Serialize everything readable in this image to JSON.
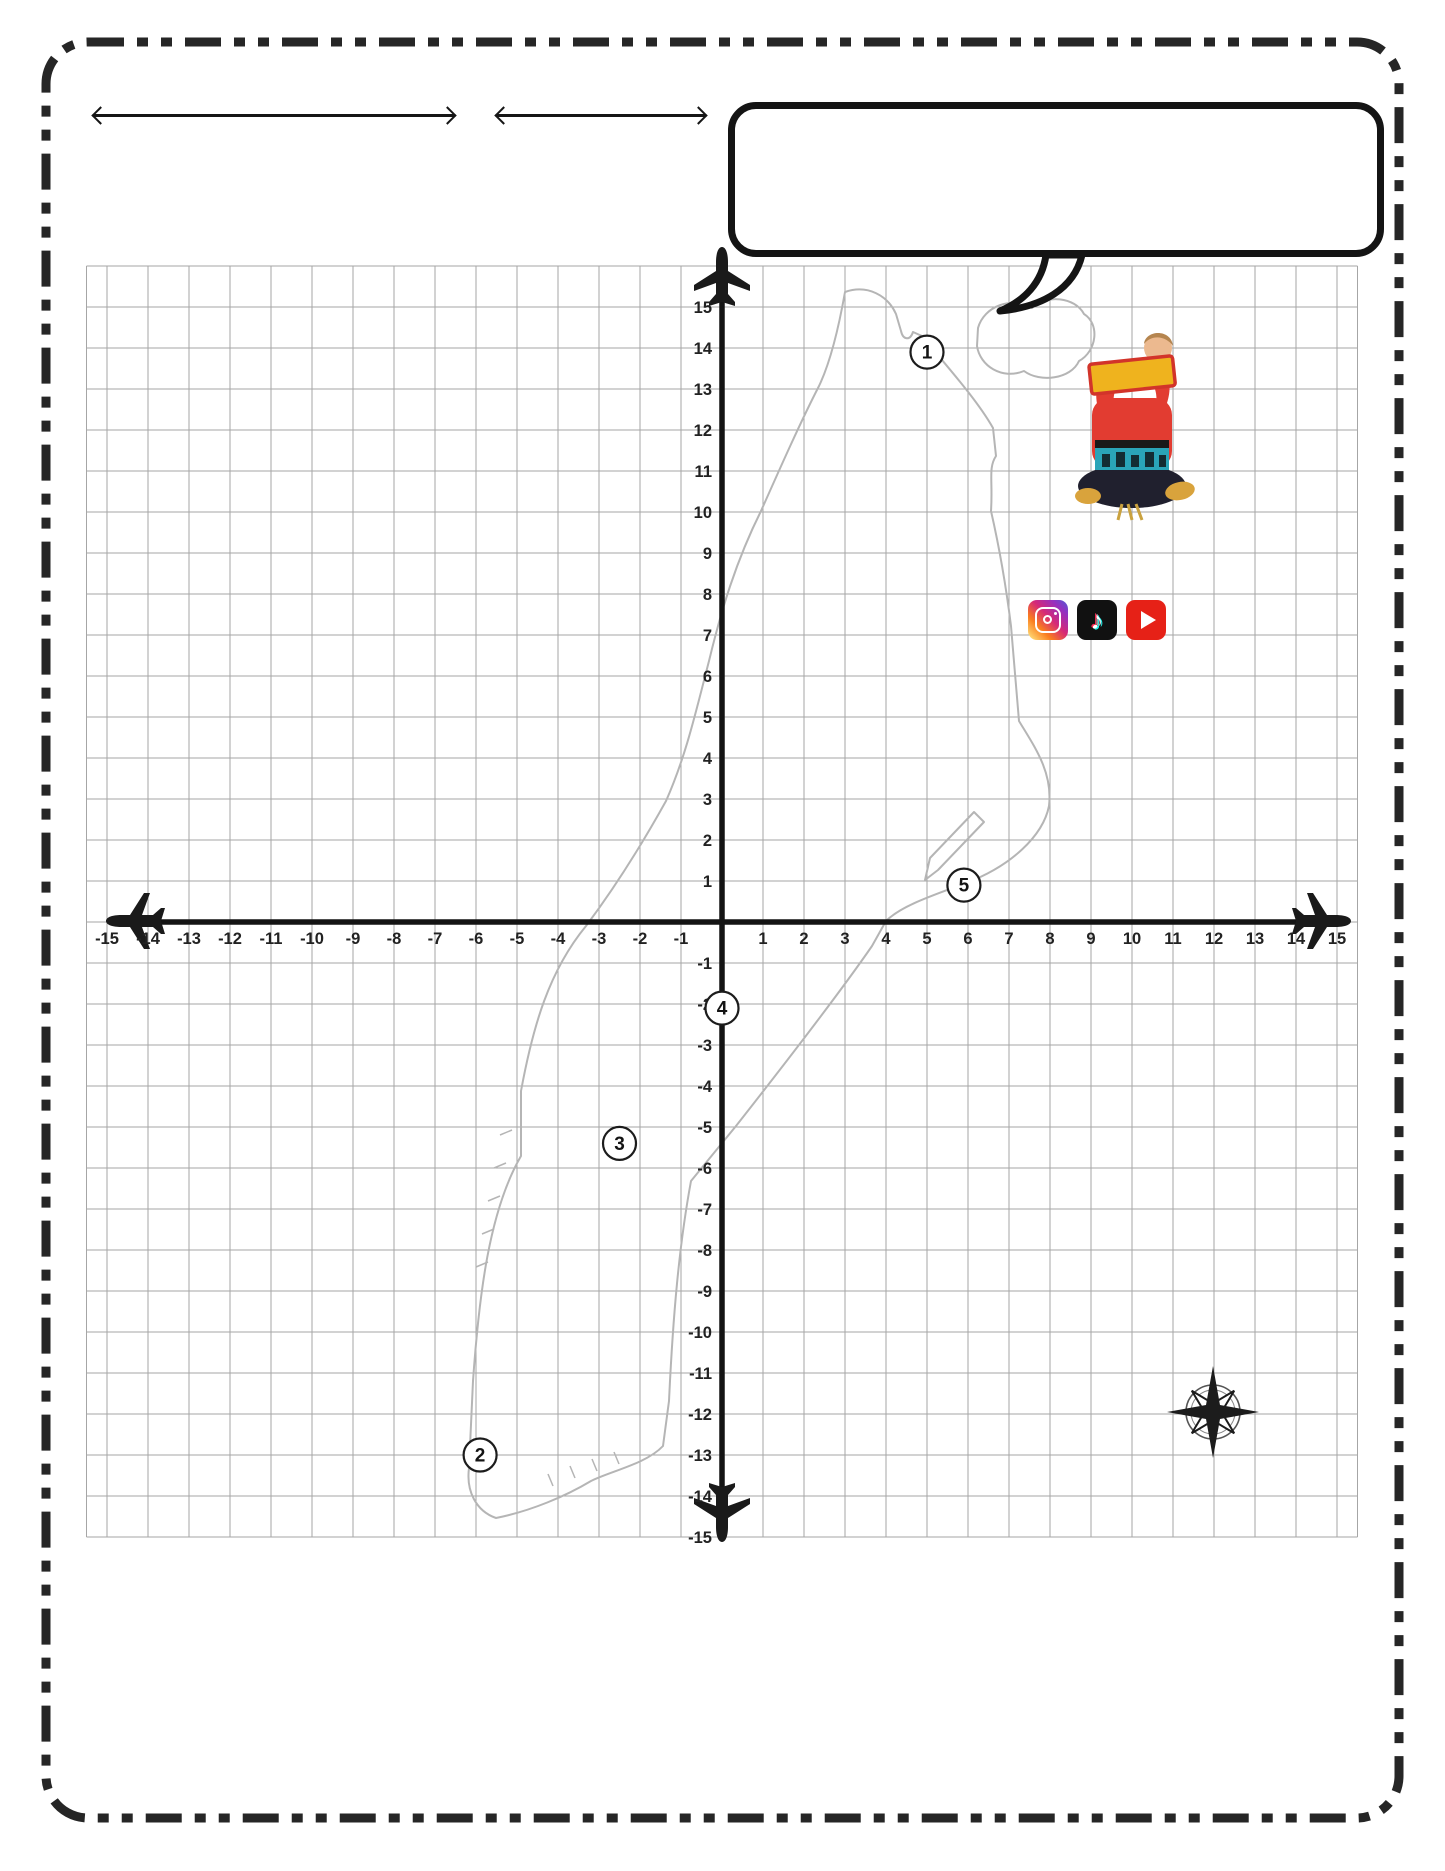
{
  "header": {
    "name_label": "Name",
    "date_label": "Date",
    "explore_label": "explore",
    "city_line": "NEW YORK CITY",
    "title": "MANHATTAN"
  },
  "speech_bubble": {
    "lines": [
      "First, choose 10 different colors, & shade in the circles at the",
      "bottom. Then, FIND points 1-5 on your map, shade in the matching",
      "color, & write the coordinate (x,y). After, use the coordinates &",
      "your colors to PLOT the remaining destinations. Last, label locations."
    ]
  },
  "brand": {
    "with_label": "with",
    "name_line1": "TRAVELING",
    "name_line2": "MISS T.",
    "registered_mark": "®",
    "banner_text": "BROADWAY",
    "social_icons": [
      "instagram-icon",
      "tiktok-icon",
      "youtube-icon"
    ]
  },
  "chart_data": {
    "type": "scatter",
    "title": "Manhattan coordinate plane map",
    "xlabel": "x-axis",
    "ylabel": "y-axis",
    "xlim": [
      -15,
      15
    ],
    "ylim": [
      -15,
      15
    ],
    "grid": true,
    "x_ticks": [
      -15,
      -14,
      -13,
      -12,
      -11,
      -10,
      -9,
      -8,
      -7,
      -6,
      -5,
      -4,
      -3,
      -2,
      -1,
      1,
      2,
      3,
      4,
      5,
      6,
      7,
      8,
      9,
      10,
      11,
      12,
      13,
      14,
      15
    ],
    "y_ticks": [
      15,
      14,
      13,
      12,
      11,
      10,
      9,
      8,
      7,
      6,
      5,
      4,
      3,
      2,
      1,
      -1,
      -2,
      -3,
      -4,
      -5,
      -6,
      -7,
      -8,
      -9,
      -10,
      -11,
      -12,
      -13,
      -14,
      -15
    ],
    "points": [
      {
        "label": "1",
        "x": 5,
        "y": 13.9
      },
      {
        "label": "2",
        "x": -5.9,
        "y": -13
      },
      {
        "label": "3",
        "x": -2.5,
        "y": -5.4
      },
      {
        "label": "4",
        "x": 0,
        "y": -2.1
      },
      {
        "label": "5",
        "x": 5.9,
        "y": 0.9
      }
    ]
  },
  "compass": {
    "north": "N",
    "west": "W",
    "east": "E",
    "south": "S"
  },
  "worksheet": {
    "left_rows": [
      {
        "num": "1",
        "name": "Inwood Hill Park",
        "x": "",
        "y": ""
      },
      {
        "num": "2",
        "name": "One World Trade Center",
        "x": "",
        "y": ""
      },
      {
        "num": "3",
        "name": "Times Square",
        "x": "",
        "y": ""
      },
      {
        "num": "4",
        "name": "Metropolitan Museum of Art",
        "x": "",
        "y": ""
      },
      {
        "num": "5",
        "name": "Randall's Island",
        "x": "",
        "y": ""
      }
    ],
    "right_rows": [
      {
        "name": "Central Park",
        "x": "-1",
        "y": "-3"
      },
      {
        "name": "Apollo Theatre",
        "x": "2",
        "y": "3.5"
      },
      {
        "name": "The Hudson River",
        "x": "-1",
        "y": "5"
      },
      {
        "name": "Roosevelt Island",
        "x": "2",
        "y": "-4"
      },
      {
        "name": "Bryant Park",
        "x": "-2.5",
        "y": "-6"
      }
    ]
  },
  "watermark": {
    "word1": "PILOT",
    "of": "OF",
    "the": "THE",
    "word2": "COORDINATE",
    "word3": "PLANE",
    "tm": "™"
  },
  "footer": {
    "copyright": "© NYC Math Maps Collection, NBTutors LLC, 2022-2025"
  },
  "colors": {
    "ink": "#161616",
    "map_outline": "#b5b5b5",
    "grid_line": "#a6a6a6",
    "watermark_yellow": "#f2cd64",
    "watermark_gray": "#a8a8a8",
    "youtube_red": "#e62117",
    "tiktok_black": "#111111",
    "sweater_red": "#e23c31",
    "banner_yellow": "#efb31e",
    "band_teal": "#2aa4b8"
  }
}
